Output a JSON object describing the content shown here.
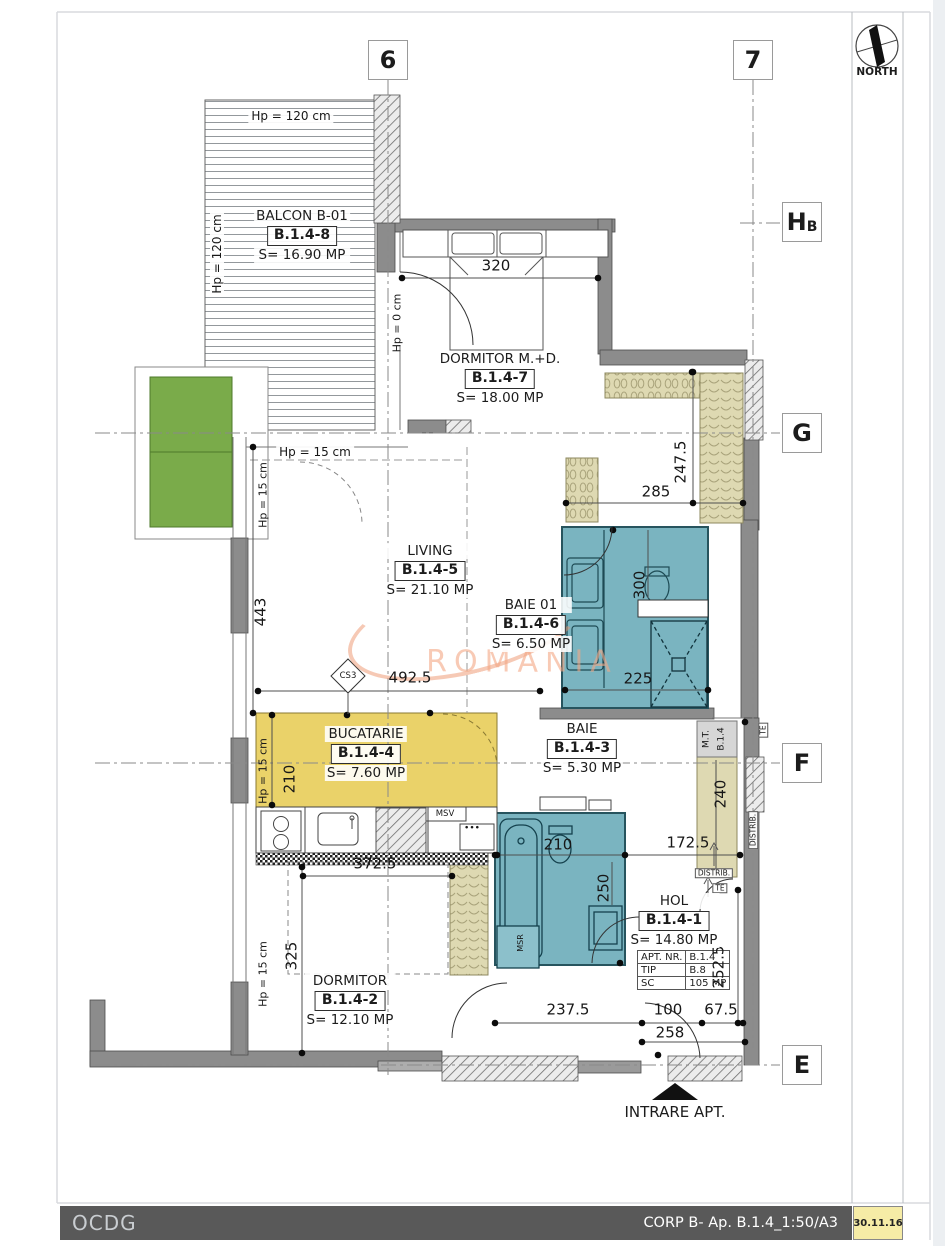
{
  "north": {
    "label": "NORTH"
  },
  "grid": {
    "cols": [
      {
        "label": "6",
        "x": 388,
        "y": 60
      },
      {
        "label": "7",
        "x": 753,
        "y": 60
      }
    ],
    "rows": [
      {
        "label": "H",
        "sub": "B",
        "x": 802,
        "y": 222
      },
      {
        "label": "G",
        "sub": "",
        "x": 802,
        "y": 433
      },
      {
        "label": "F",
        "sub": "",
        "x": 802,
        "y": 763
      },
      {
        "label": "E",
        "sub": "",
        "x": 802,
        "y": 1065
      }
    ]
  },
  "rooms": [
    {
      "name": "BALCON B-01",
      "code": "B.1.4-8",
      "area": "S= 16.90 MP",
      "cx": 302,
      "cy": 208
    },
    {
      "name": "DORMITOR M.+D.",
      "code": "B.1.4-7",
      "area": "S= 18.00 MP",
      "cx": 500,
      "cy": 351
    },
    {
      "name": "LIVING",
      "code": "B.1.4-5",
      "area": "S= 21.10 MP",
      "cx": 430,
      "cy": 543
    },
    {
      "name": "BAIE 01",
      "code": "B.1.4-6",
      "area": "S= 6.50 MP",
      "cx": 531,
      "cy": 597
    },
    {
      "name": "BUCATARIE",
      "code": "B.1.4-4",
      "area": "S= 7.60 MP",
      "cx": 366,
      "cy": 726
    },
    {
      "name": "BAIE",
      "code": "B.1.4-3",
      "area": "S= 5.30 MP",
      "cx": 582,
      "cy": 721
    },
    {
      "name": "HOL",
      "code": "B.1.4-1",
      "area": "S= 14.80 MP",
      "cx": 674,
      "cy": 893
    },
    {
      "name": "DORMITOR",
      "code": "B.1.4-2",
      "area": "S= 12.10 MP",
      "cx": 350,
      "cy": 973
    }
  ],
  "dimensions": [
    {
      "text": "320",
      "x": 496,
      "y": 266
    },
    {
      "text": "285",
      "x": 656,
      "y": 492
    },
    {
      "text": "247.5",
      "x": 681,
      "y": 462,
      "rot": -90
    },
    {
      "text": "300",
      "x": 640,
      "y": 585,
      "rot": -90
    },
    {
      "text": "225",
      "x": 638,
      "y": 679
    },
    {
      "text": "443",
      "x": 261,
      "y": 612,
      "rot": -90
    },
    {
      "text": "492.5",
      "x": 410,
      "y": 678
    },
    {
      "text": "210",
      "x": 290,
      "y": 779,
      "rot": -90
    },
    {
      "text": "372.5",
      "x": 375,
      "y": 864
    },
    {
      "text": "210",
      "x": 558,
      "y": 845
    },
    {
      "text": "250",
      "x": 604,
      "y": 888,
      "rot": -90
    },
    {
      "text": "172.5",
      "x": 688,
      "y": 843
    },
    {
      "text": "240",
      "x": 721,
      "y": 794,
      "rot": -90
    },
    {
      "text": "252.5",
      "x": 719,
      "y": 967,
      "rot": -90
    },
    {
      "text": "325",
      "x": 292,
      "y": 956,
      "rot": -90
    },
    {
      "text": "237.5",
      "x": 568,
      "y": 1010
    },
    {
      "text": "100",
      "x": 668,
      "y": 1010
    },
    {
      "text": "67.5",
      "x": 721,
      "y": 1010
    },
    {
      "text": "258",
      "x": 670,
      "y": 1033
    }
  ],
  "annotations": [
    {
      "text": "Hp = 120 cm",
      "x": 291,
      "y": 116,
      "fs": 12,
      "cls": "bgw"
    },
    {
      "text": "Hp = 120 cm",
      "x": 217,
      "y": 254,
      "rot": -90,
      "fs": 12,
      "cls": "bgw"
    },
    {
      "text": "Hp = 0 cm",
      "x": 397,
      "y": 323,
      "rot": -90,
      "fs": 11
    },
    {
      "text": "Hp = 15 cm",
      "x": 315,
      "y": 452,
      "fs": 12,
      "cls": "bgw"
    },
    {
      "text": "Hp = 15 cm",
      "x": 263,
      "y": 495,
      "rot": -90,
      "fs": 11
    },
    {
      "text": "Hp = 15 cm",
      "x": 263,
      "y": 771,
      "rot": -90,
      "fs": 11
    },
    {
      "text": "Hp = 15 cm",
      "x": 263,
      "y": 974,
      "rot": -90,
      "fs": 11
    },
    {
      "text": "MSV",
      "x": 445,
      "y": 814,
      "fs": 8.5
    },
    {
      "text": "•••",
      "x": 472,
      "y": 829,
      "fs": 9
    },
    {
      "text": "MSR",
      "x": 521,
      "y": 943,
      "rot": -90,
      "fs": 8
    },
    {
      "text": "M.T.",
      "x": 707,
      "y": 739,
      "rot": -90,
      "fs": 9
    },
    {
      "text": "B.1.4",
      "x": 722,
      "y": 739,
      "rot": -90,
      "fs": 9
    },
    {
      "text": "DISTRIB.",
      "x": 753,
      "y": 830,
      "rot": -90,
      "fs": 7.5,
      "cls": "boxed"
    },
    {
      "text": "DISTRIB.",
      "x": 714,
      "y": 873,
      "fs": 7.5,
      "cls": "boxed"
    },
    {
      "text": "TE",
      "x": 720,
      "y": 888,
      "fs": 7.5,
      "cls": "boxed"
    },
    {
      "text": "TE",
      "x": 763,
      "y": 730,
      "rot": -90,
      "fs": 7.5,
      "cls": "boxed"
    },
    {
      "text": "CS3",
      "x": 348,
      "y": 676,
      "fs": 8.5
    }
  ],
  "apt_table": {
    "rows": [
      [
        "APT. NR.",
        "B.1.4"
      ],
      [
        "TIP",
        "B.8"
      ],
      [
        "SC",
        "105 MP"
      ]
    ]
  },
  "entrance": {
    "label": "INTRARE APT."
  },
  "watermark": {
    "text": "ROMANIA"
  },
  "footer": {
    "left": "OCDG",
    "right": "CORP B- Ap. B.1.4_1:50/A3",
    "date": "30.11.16"
  },
  "colors": {
    "bathroom_fill": "#7ab4c0",
    "kitchen_fill": "#ead269",
    "closet_fill": "#ded9b2",
    "planter_green": "#7aab4a",
    "wall_gray": "#8c8c8c",
    "footer_bar": "#595959",
    "date_bg": "#f6eca6",
    "watermark_orange": "#f3a684"
  }
}
